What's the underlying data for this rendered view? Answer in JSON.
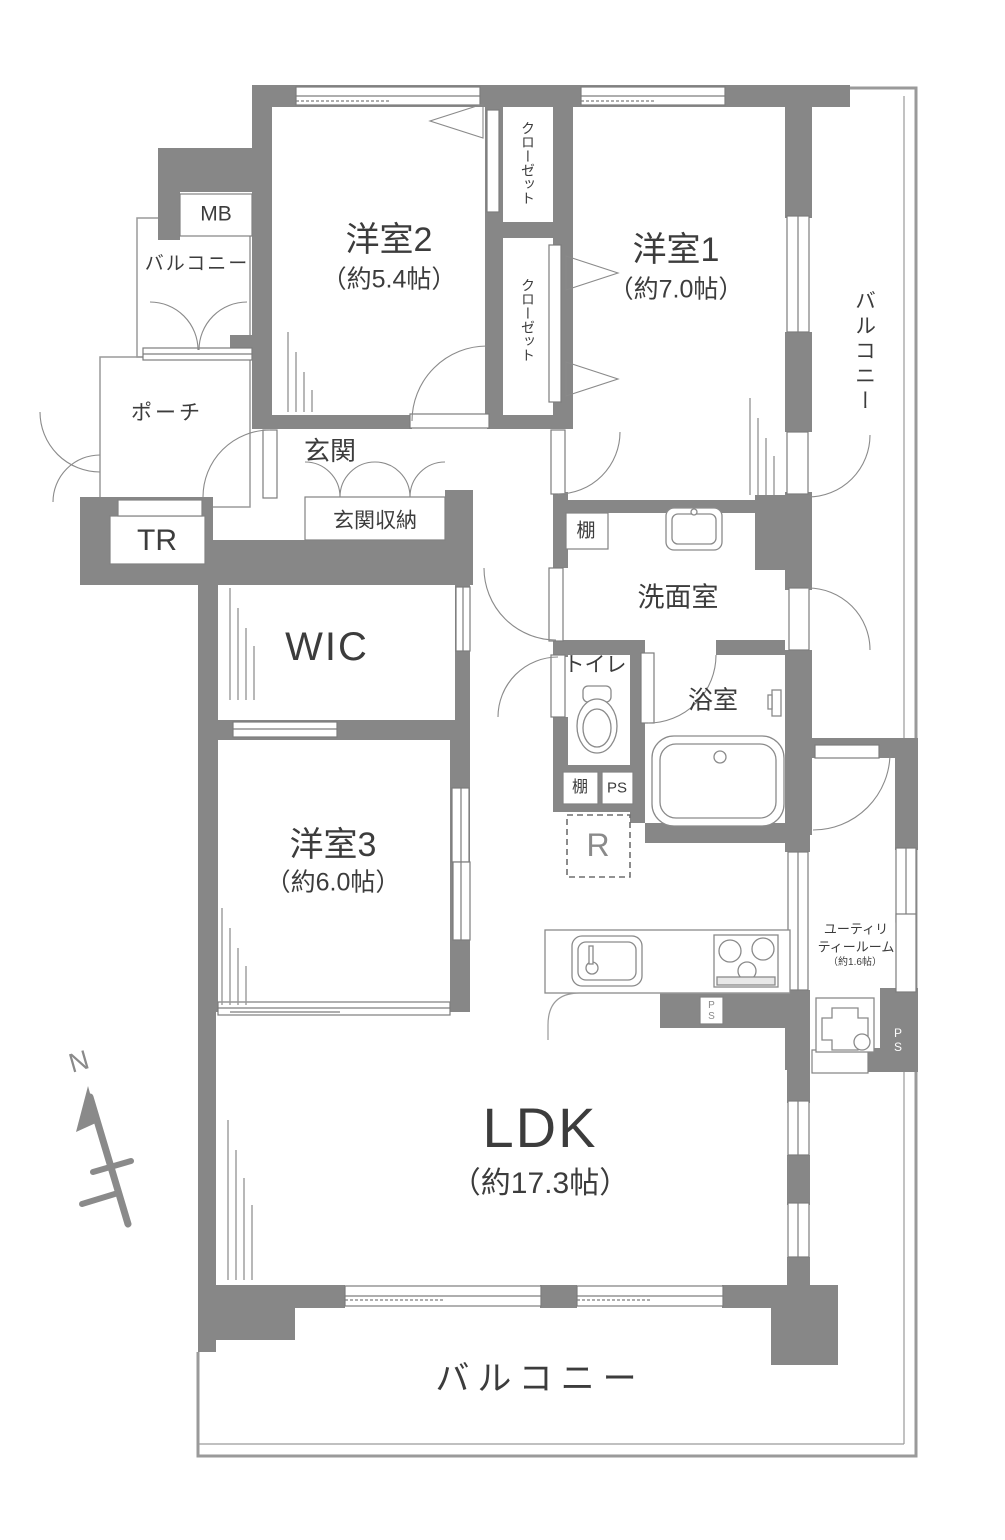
{
  "rooms": {
    "yoshitsu2": {
      "name": "洋室2",
      "size": "（約5.4帖）"
    },
    "yoshitsu1": {
      "name": "洋室1",
      "size": "（約7.0帖）"
    },
    "yoshitsu3": {
      "name": "洋室3",
      "size": "（約6.0帖）"
    },
    "ldk": {
      "name": "LDK",
      "size": "（約17.3帖）"
    },
    "wic": {
      "name": "WIC"
    },
    "senmenshitsu": {
      "name": "洗面室"
    },
    "yokushitsu": {
      "name": "浴室"
    },
    "toilet": {
      "name": "トイレ"
    },
    "genkan": {
      "name": "玄関"
    },
    "genkan_shuno": {
      "name": "玄関収納"
    },
    "utility": {
      "line1": "ユーティリ",
      "line2": "ティールーム",
      "size": "（約1.6帖）"
    },
    "closet_upper": {
      "name": "クローゼット"
    },
    "closet_lower": {
      "name": "クローゼット"
    },
    "porch": {
      "name": "ポーチ"
    },
    "balcony_left": {
      "name": "バルコニー"
    },
    "balcony_right": {
      "name": "バルコニー"
    },
    "balcony_bottom": {
      "name": "バルコニー"
    }
  },
  "labels": {
    "mb": "MB",
    "tr": "TR",
    "tana_washroom": "棚",
    "tana_hall": "棚",
    "ps_hall": "PS",
    "ps_kitchen": "PS",
    "ps_utility": "PS",
    "refrigerator": "R",
    "north": "N"
  },
  "colors": {
    "wall": "#878787",
    "thin_line": "#8f8f8f",
    "text": "#3c3c3c"
  }
}
